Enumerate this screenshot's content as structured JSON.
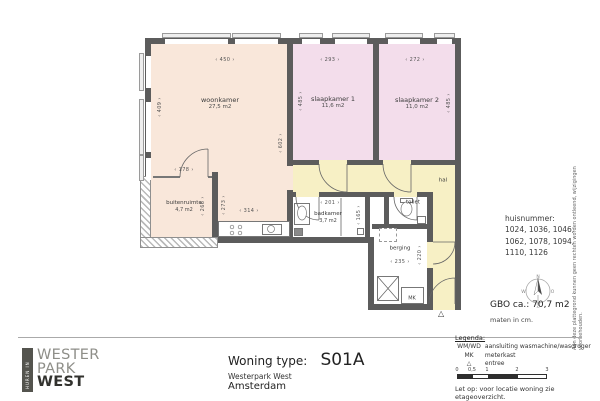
{
  "titleblock": {
    "label": "Woning type:",
    "value": "S01A",
    "project": "Westerpark West",
    "city": "Amsterdam"
  },
  "logo": {
    "vertical": "HUREN IN",
    "line1": "WESTER",
    "line2": "PARK",
    "line3": "WEST"
  },
  "info": {
    "huisnummer_label": "huisnummer:",
    "huisnummer_lines": [
      "1024, 1036, 1046,",
      "1062, 1078, 1094,",
      "1110, 1126"
    ],
    "gbo": "GBO ca.:  70,7 m2",
    "units": "maten in cm.",
    "compass": {
      "n": "N",
      "o": "O",
      "z": "Z",
      "w": "W"
    }
  },
  "legend": {
    "heading": "Legenda:",
    "rows": [
      {
        "key": "WM/WD",
        "value": "aansluiting wasmachine/wasdroger"
      },
      {
        "key": "MK",
        "value": "meterkast"
      },
      {
        "key": "△",
        "value": "entree"
      }
    ],
    "scale_ticks": [
      "0",
      "0,5",
      "1",
      "2",
      "3"
    ]
  },
  "notes": {
    "side": "Aan deze plattegrond kunnen geen rechten worden ontleend, wijzigingen voorbehouden.",
    "bottom": "Let op:  voor locatie woning zie etageoverzicht."
  },
  "plan": {
    "rooms": [
      {
        "name": "woonkamer",
        "area": "27,5 m2"
      },
      {
        "name": "slaapkamer 1",
        "area": "11,6 m2"
      },
      {
        "name": "slaapkamer 2",
        "area": "11,0 m2"
      },
      {
        "name": "buitenruimte",
        "area": "4,7 m2"
      },
      {
        "name": "badkamer",
        "area": "3,7 m2"
      },
      {
        "name": "toilet"
      },
      {
        "name": "berging"
      },
      {
        "name": "hal"
      }
    ],
    "mk_label": "MK",
    "entree_marker": "△",
    "dims": {
      "top_woonkamer": "450",
      "top_sk1": "293",
      "top_sk2": "272",
      "left_woonkamer": "409",
      "right_woonkamer": "602",
      "sk1_depth": "485",
      "sk2_depth": "485",
      "buiten_w": "178",
      "buiten_h": "266",
      "strip_h": "273",
      "kitchen_w": "314",
      "badkamer_w": "201",
      "badkamer_h": "165",
      "berging_w": "235",
      "berging_h": "220"
    }
  },
  "colors": {
    "woonkamer": "#f9e7da",
    "slaapkamer": "#f3ddeb",
    "buitenruimte": "#e4edc9",
    "hal": "#f7f0c5",
    "badkamer": "#d2e4e2",
    "berging": "#dcdcdc",
    "wall": "#5c5c5c"
  }
}
